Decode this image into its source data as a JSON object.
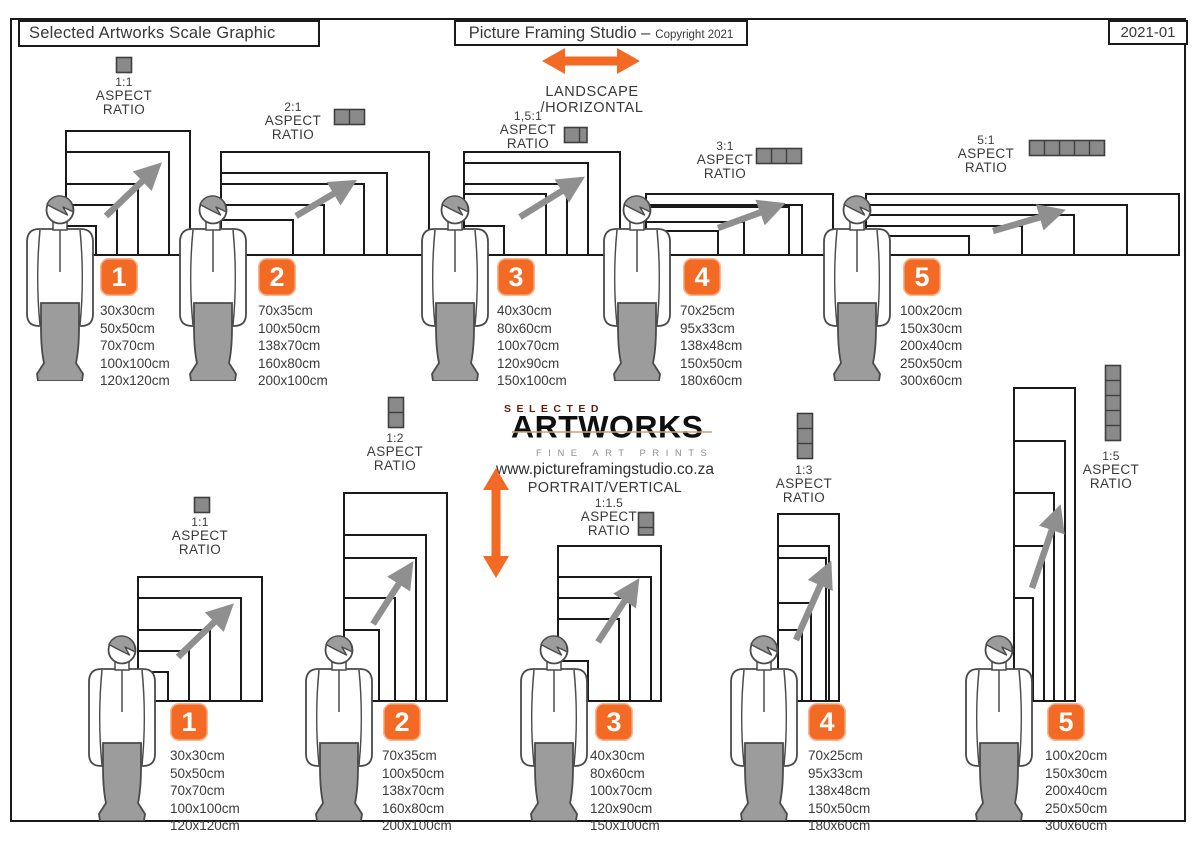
{
  "header": {
    "title": "Selected Artworks Scale Graphic",
    "studio_name": "Picture Framing Studio –",
    "copyright": "Copyright 2021",
    "doc_code": "2021-01"
  },
  "landscape_section": {
    "label": "LANDSCAPE /HORIZONTAL"
  },
  "portrait_section": {
    "label": "PORTRAIT/VERTICAL",
    "website": "www.pictureframingstudio.co.za"
  },
  "logo": {
    "line1": "SELECTED",
    "line2": "ARTWORKS",
    "line3": "FINE ART PRINTS"
  },
  "aspect_caption": {
    "word1": "ASPECT",
    "word2": "RATIO"
  },
  "colors": {
    "accent": "#F26A24",
    "frame_stroke": "#1a1a1a",
    "figure_gray": "#9c9c9c",
    "icon_gray": "#8a8a8a"
  },
  "groups": {
    "landscape": [
      {
        "number": "1",
        "ratio": "1:1",
        "icon": {
          "w": 1,
          "h": 1
        },
        "sizes": [
          "30x30cm",
          "50x50cm",
          "70x70cm",
          "100x100cm",
          "120x120cm"
        ]
      },
      {
        "number": "2",
        "ratio": "2:1",
        "icon": {
          "w": 2,
          "h": 1
        },
        "sizes": [
          "70x35cm",
          "100x50cm",
          "138x70cm",
          "160x80cm",
          "200x100cm"
        ]
      },
      {
        "number": "3",
        "ratio": "1,5:1",
        "icon": {
          "w": 1.5,
          "h": 1
        },
        "sizes": [
          "40x30cm",
          "80x60cm",
          "100x70cm",
          "120x90cm",
          "150x100cm"
        ]
      },
      {
        "number": "4",
        "ratio": "3:1",
        "icon": {
          "w": 3,
          "h": 1
        },
        "sizes": [
          "70x25cm",
          "95x33cm",
          "138x48cm",
          "150x50cm",
          "180x60cm"
        ]
      },
      {
        "number": "5",
        "ratio": "5:1",
        "icon": {
          "w": 5,
          "h": 1
        },
        "sizes": [
          "100x20cm",
          "150x30cm",
          "200x40cm",
          "250x50cm",
          "300x60cm"
        ]
      }
    ],
    "portrait": [
      {
        "number": "1",
        "ratio": "1:1",
        "icon": {
          "w": 1,
          "h": 1
        },
        "sizes": [
          "30x30cm",
          "50x50cm",
          "70x70cm",
          "100x100cm",
          "120x120cm"
        ]
      },
      {
        "number": "2",
        "ratio": "1:2",
        "icon": {
          "w": 1,
          "h": 2
        },
        "sizes": [
          "70x35cm",
          "100x50cm",
          "138x70cm",
          "160x80cm",
          "200x100cm"
        ]
      },
      {
        "number": "3",
        "ratio": "1:1.5",
        "icon": {
          "w": 1,
          "h": 1.5
        },
        "sizes": [
          "40x30cm",
          "80x60cm",
          "100x70cm",
          "120x90cm",
          "150x100cm"
        ]
      },
      {
        "number": "4",
        "ratio": "1:3",
        "icon": {
          "w": 1,
          "h": 3
        },
        "sizes": [
          "70x25cm",
          "95x33cm",
          "138x48cm",
          "150x50cm",
          "180x60cm"
        ]
      },
      {
        "number": "5",
        "ratio": "1:5",
        "icon": {
          "w": 1,
          "h": 5
        },
        "sizes": [
          "100x20cm",
          "150x30cm",
          "200x40cm",
          "250x50cm",
          "300x60cm"
        ]
      }
    ]
  }
}
